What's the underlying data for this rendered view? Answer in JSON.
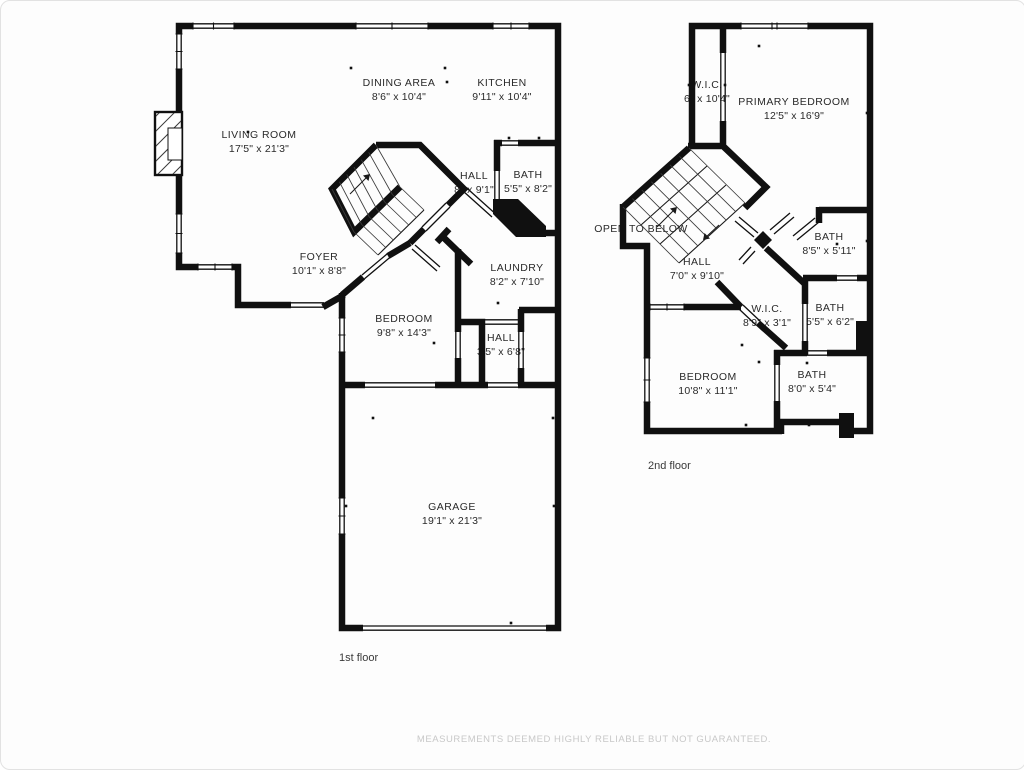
{
  "colors": {
    "wall": "#101010",
    "text": "#2a2a2a",
    "muted_text": "#c8c8c8",
    "background": "#fdfdfd"
  },
  "disclaimer": "MEASUREMENTS DEEMED HIGHLY RELIABLE BUT NOT GUARANTEED.",
  "floor1": {
    "caption": "1st floor",
    "rooms": {
      "living_room": {
        "label": "LIVING ROOM",
        "dims": "17'5\" x 21'3\""
      },
      "dining_area": {
        "label": "DINING AREA",
        "dims": "8'6\" x 10'4\""
      },
      "kitchen": {
        "label": "KITCHEN",
        "dims": "9'11\" x 10'4\""
      },
      "hall": {
        "label": "HALL",
        "dims": "8\" x 9'1\""
      },
      "bath": {
        "label": "BATH",
        "dims": "5'5\" x 8'2\""
      },
      "foyer": {
        "label": "FOYER",
        "dims": "10'1\" x 8'8\""
      },
      "laundry": {
        "label": "LAUNDRY",
        "dims": "8'2\" x 7'10\""
      },
      "bedroom": {
        "label": "BEDROOM",
        "dims": "9'8\" x 14'3\""
      },
      "hall_rear": {
        "label": "HALL",
        "dims": "3'5\" x 6'8\""
      },
      "garage": {
        "label": "GARAGE",
        "dims": "19'1\" x 21'3\""
      }
    }
  },
  "floor2": {
    "caption": "2nd floor",
    "rooms": {
      "wic": {
        "label": "W.I.C.",
        "dims": "6\" x 10'4\""
      },
      "primary_bedroom": {
        "label": "PRIMARY BEDROOM",
        "dims": "12'5\" x 16'9\""
      },
      "open_to_below": {
        "label": "OPEN TO BELOW"
      },
      "hall": {
        "label": "HALL",
        "dims": "7'0\" x 9'10\""
      },
      "bath_upper": {
        "label": "BATH",
        "dims": "8'5\" x 5'11\""
      },
      "wic2": {
        "label": "W.I.C.",
        "dims": "8'9\" x 3'1\""
      },
      "bath_mid": {
        "label": "BATH",
        "dims": "5'5\" x 6'2\""
      },
      "bedroom": {
        "label": "BEDROOM",
        "dims": "10'8\" x 11'1\""
      },
      "bath_lower": {
        "label": "BATH",
        "dims": "8'0\" x 5'4\""
      }
    }
  }
}
